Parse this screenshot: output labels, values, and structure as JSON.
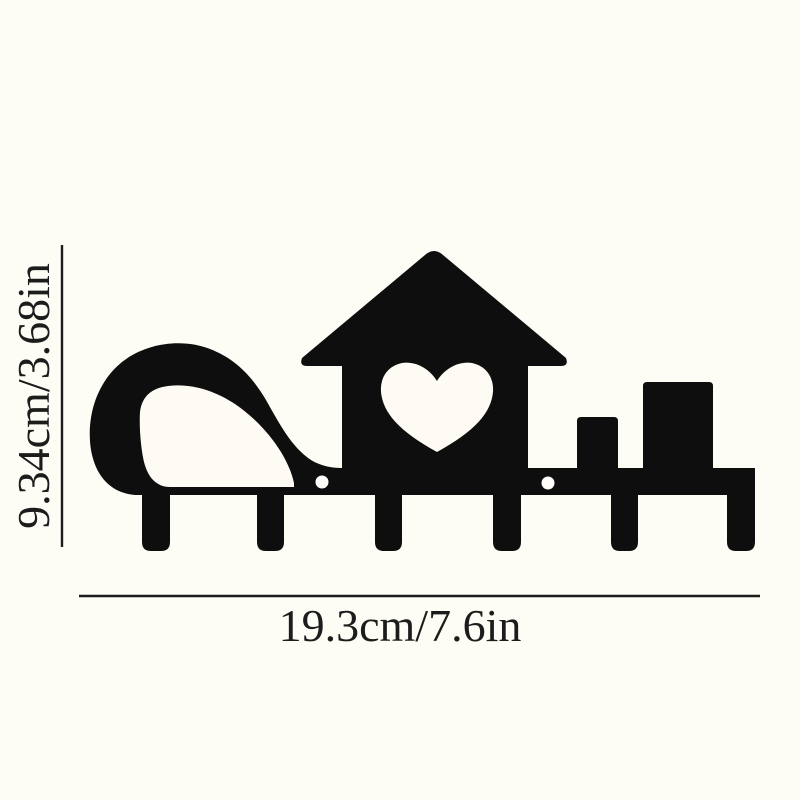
{
  "page": {
    "background": "#fdfcf5"
  },
  "colors": {
    "silhouette": "#0e0e0e",
    "cutout": "#fdfbf4",
    "hole": "#fffefa",
    "line": "#1c1c1c",
    "text": "#1c1c1c"
  },
  "dimensions": {
    "height_label": "9.34cm/3.68in",
    "width_label": "19.3cm/7.6in"
  },
  "product": {
    "icon": "key-rack-wall-hook-silhouette",
    "hook_count": 6,
    "mounting_hole_count": 2,
    "motifs": [
      "swirl-wave",
      "house-with-heart-cutout",
      "two-blocks",
      "six-hooks"
    ]
  }
}
